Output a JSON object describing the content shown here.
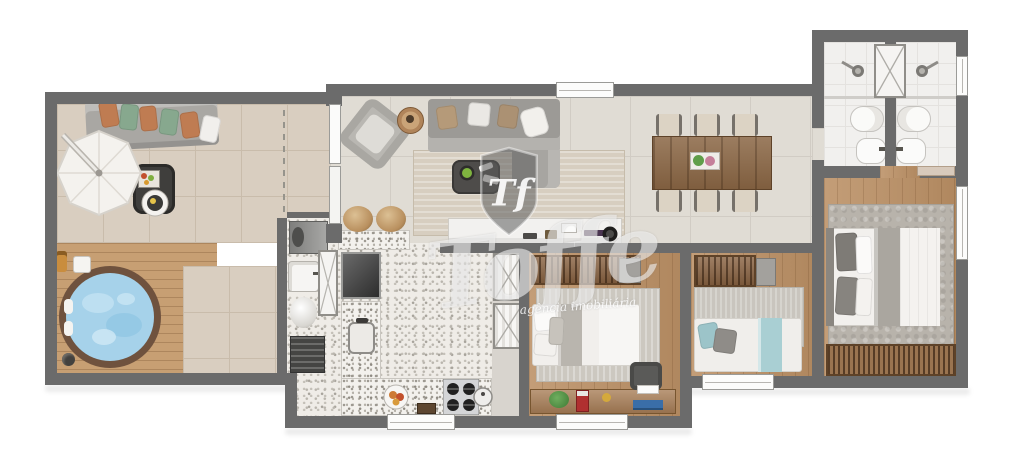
{
  "watermark": {
    "monogram": "Tf",
    "brand": "Toffe",
    "tagline": "agência imobiliária"
  },
  "palette": {
    "wall": "#6b6b6b",
    "balcony_tile": "#d9cec0",
    "living_tile": "#e0dcd4",
    "deck_wood": "#c79f73",
    "bedroom_wood": "#bb9065",
    "granite_counter": "#f3f1ed",
    "hot_tub_water": "#a6d2ea",
    "sofa_gray": "#9c9a96",
    "pillow_orange": "#bf7c52",
    "pillow_green": "#87a88e",
    "dining_wood": "#8a6644",
    "teal_blanket": "#a9cfd3",
    "living_rug": "#d7cec0"
  }
}
